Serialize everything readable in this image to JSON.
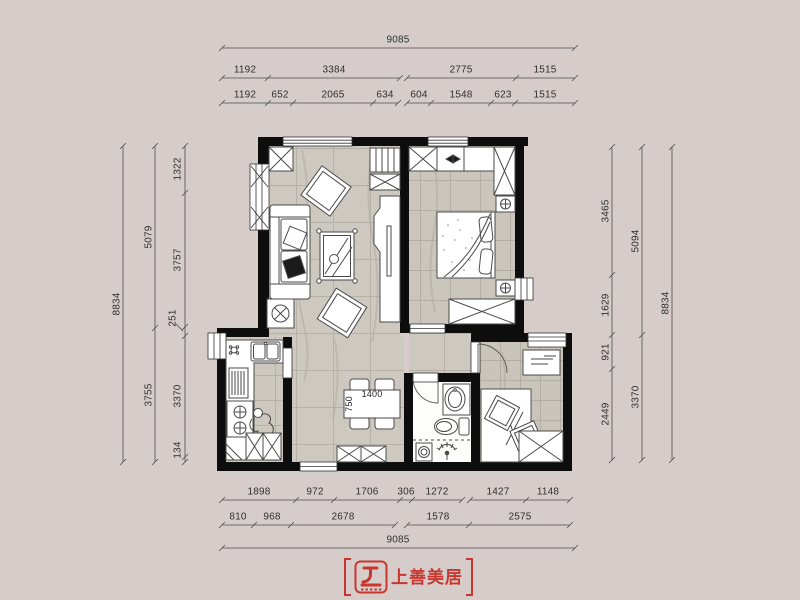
{
  "background_color": "#d6cdcb",
  "wall_color": "#0d0d0d",
  "floor_color": "#cdc9c0",
  "accent_red": "#c8372f",
  "dimensions": {
    "top": {
      "overall": "9085",
      "row2": [
        "1192",
        "3384",
        "2775",
        "1515"
      ],
      "row3": [
        "1192",
        "652",
        "2065",
        "634",
        "604",
        "1548",
        "623",
        "1515"
      ]
    },
    "bottom": {
      "row1": [
        "1898",
        "972",
        "1706",
        "306",
        "1272",
        "1427",
        "1148"
      ],
      "row2": [
        "810",
        "968",
        "2678",
        "1578",
        "2575"
      ],
      "overall": "9085"
    },
    "left": {
      "outer": "8834",
      "mid": [
        "5079",
        "3755"
      ],
      "inner": [
        "1322",
        "3757",
        "251",
        "3370",
        "134"
      ]
    },
    "right": {
      "inner": [
        "3465",
        "1629",
        "921",
        "2449"
      ],
      "mid": [
        "5094",
        "3370"
      ],
      "outer": "8834"
    },
    "table": {
      "width": "1400",
      "depth": "750"
    }
  },
  "logo": {
    "text": "上善美居",
    "icon": "shangshan-meiju-logo-icon",
    "color": "#c8372f"
  }
}
